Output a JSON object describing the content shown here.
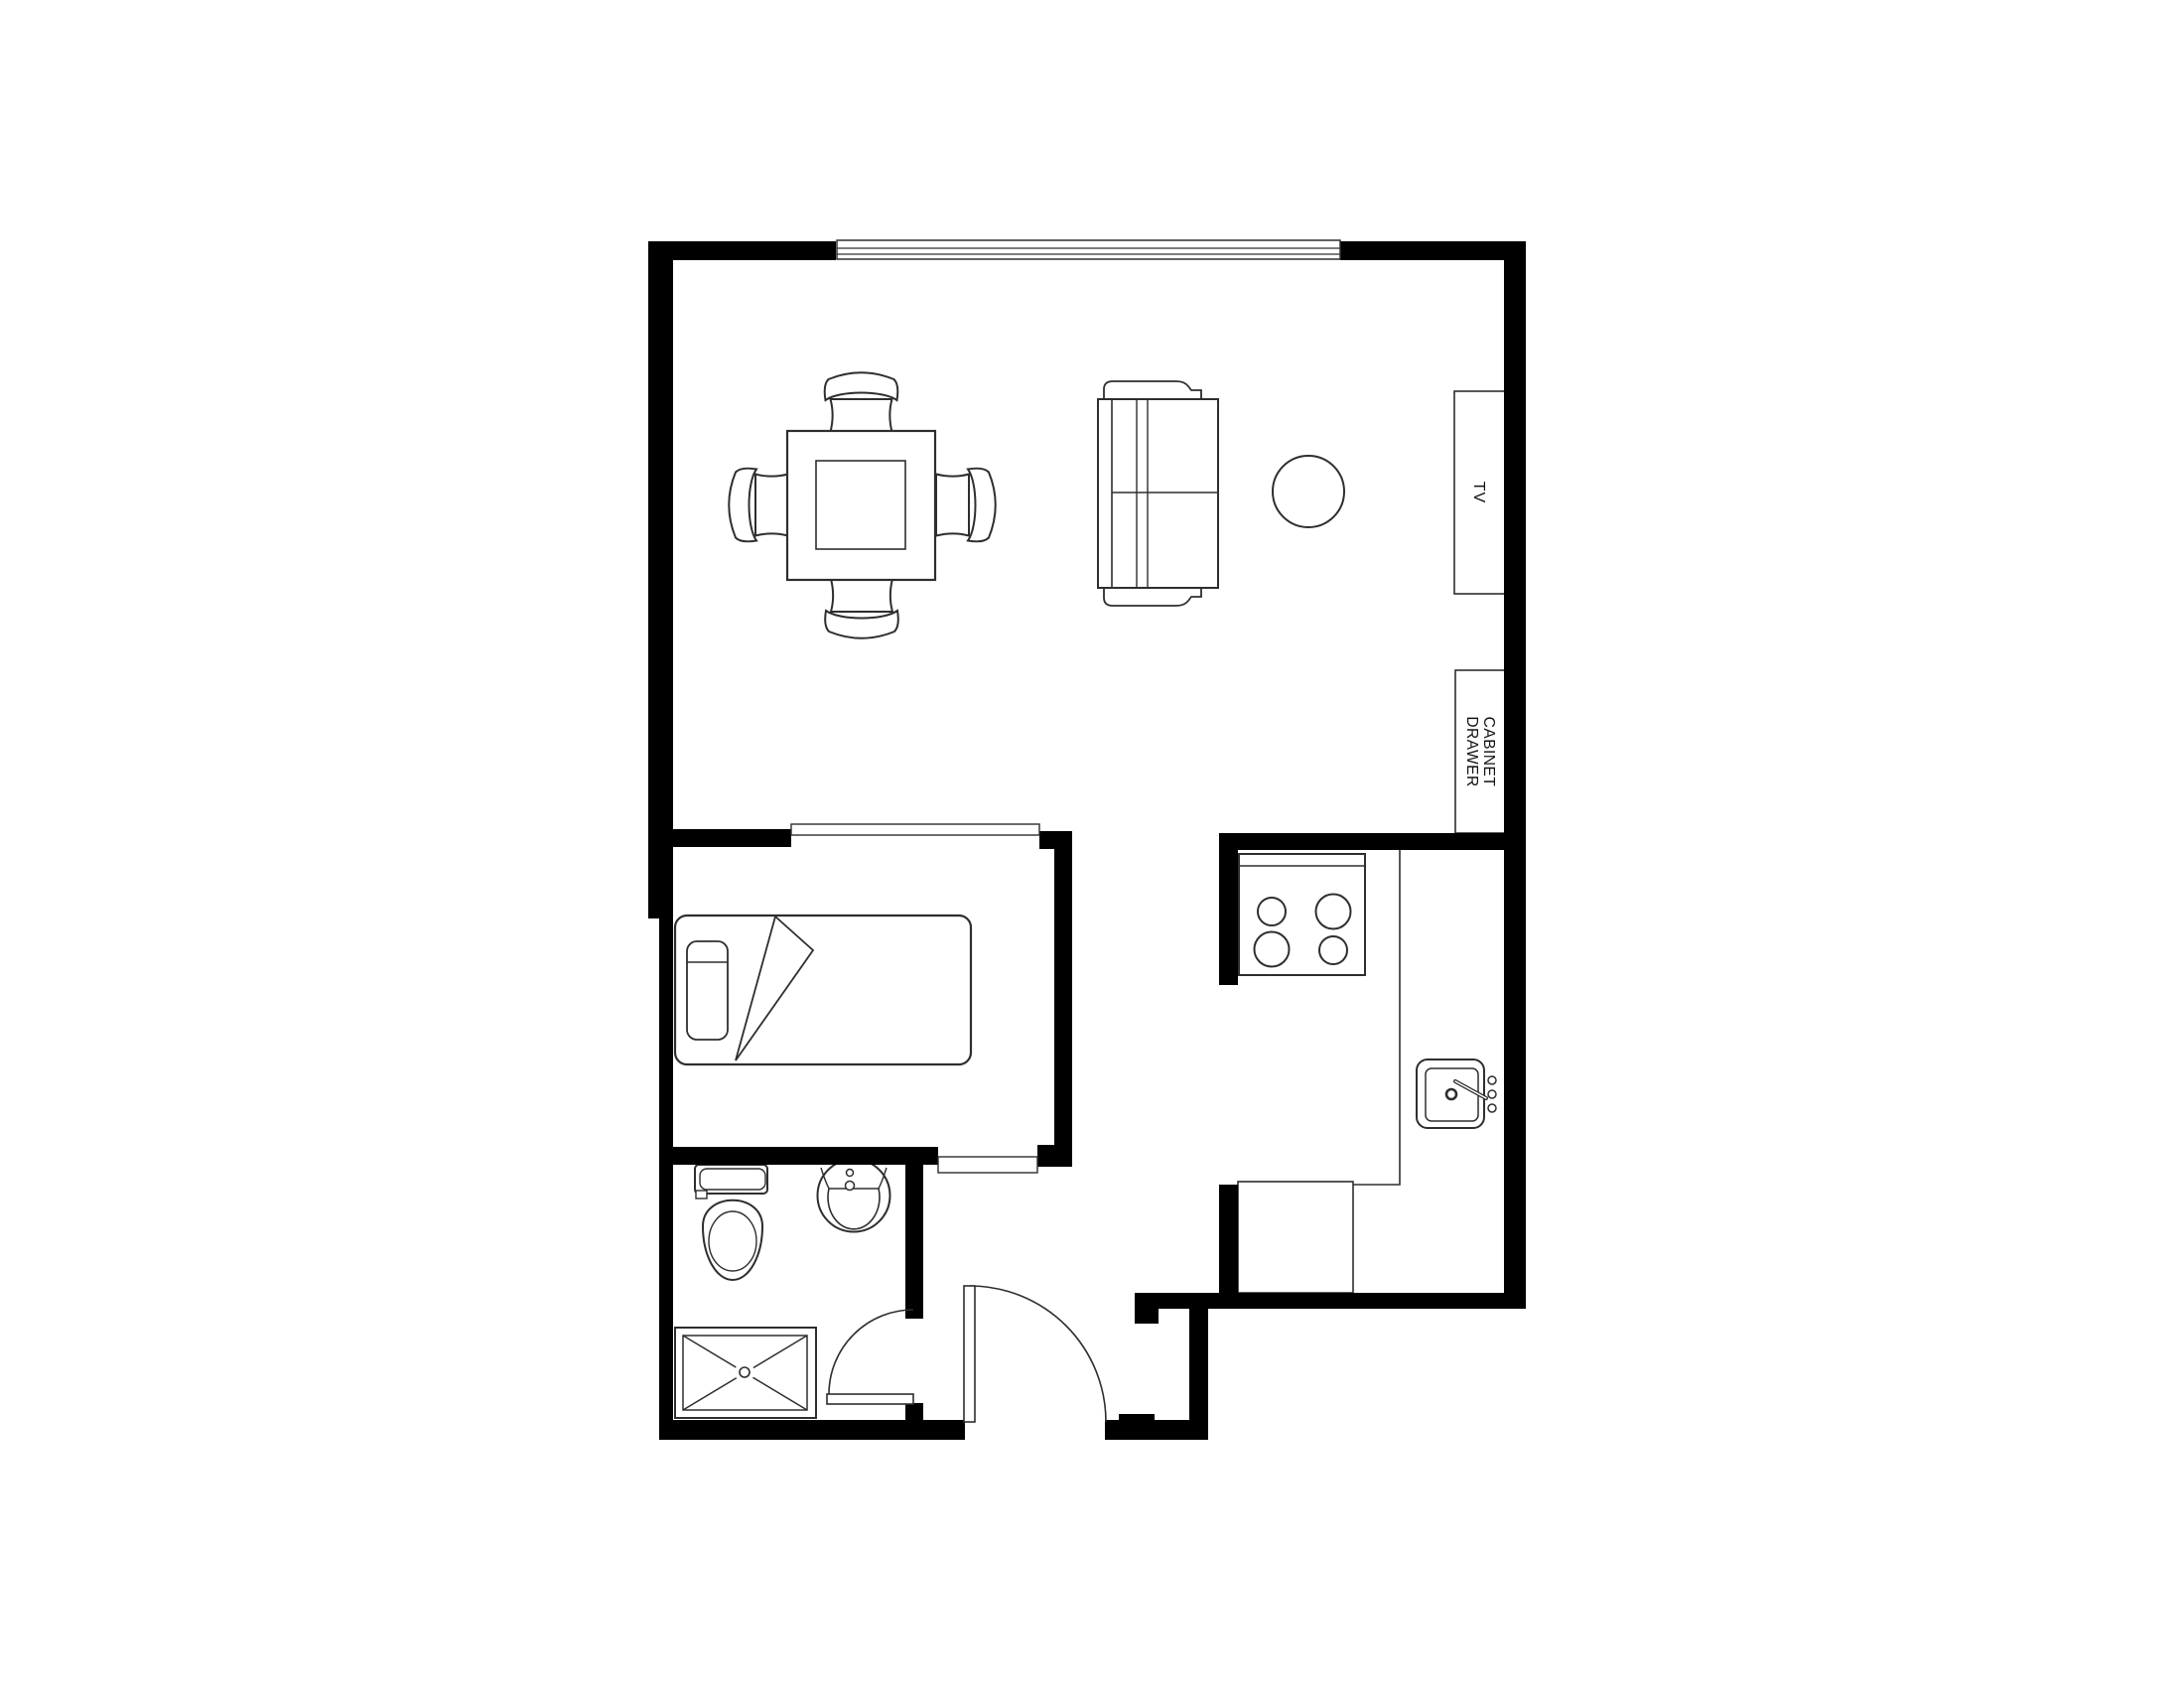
{
  "labels": {
    "tv": "TV",
    "cabinet_line1": "CABINET",
    "cabinet_line2": "DRAWER"
  },
  "colors": {
    "wall": "#000000",
    "furniture_line": "#2e2e2e",
    "background": "#ffffff"
  },
  "fixtures": [
    "window",
    "dining-table",
    "dining-chair",
    "sofa",
    "round-side-table",
    "tv-console",
    "cabinet-drawer",
    "cased-opening",
    "bed",
    "pillow",
    "blanket-fold",
    "toilet",
    "bathroom-sink",
    "shower",
    "swing-door",
    "entry-door",
    "stove",
    "burner",
    "kitchen-counter",
    "kitchen-cabinet",
    "kitchen-sink",
    "faucet"
  ]
}
